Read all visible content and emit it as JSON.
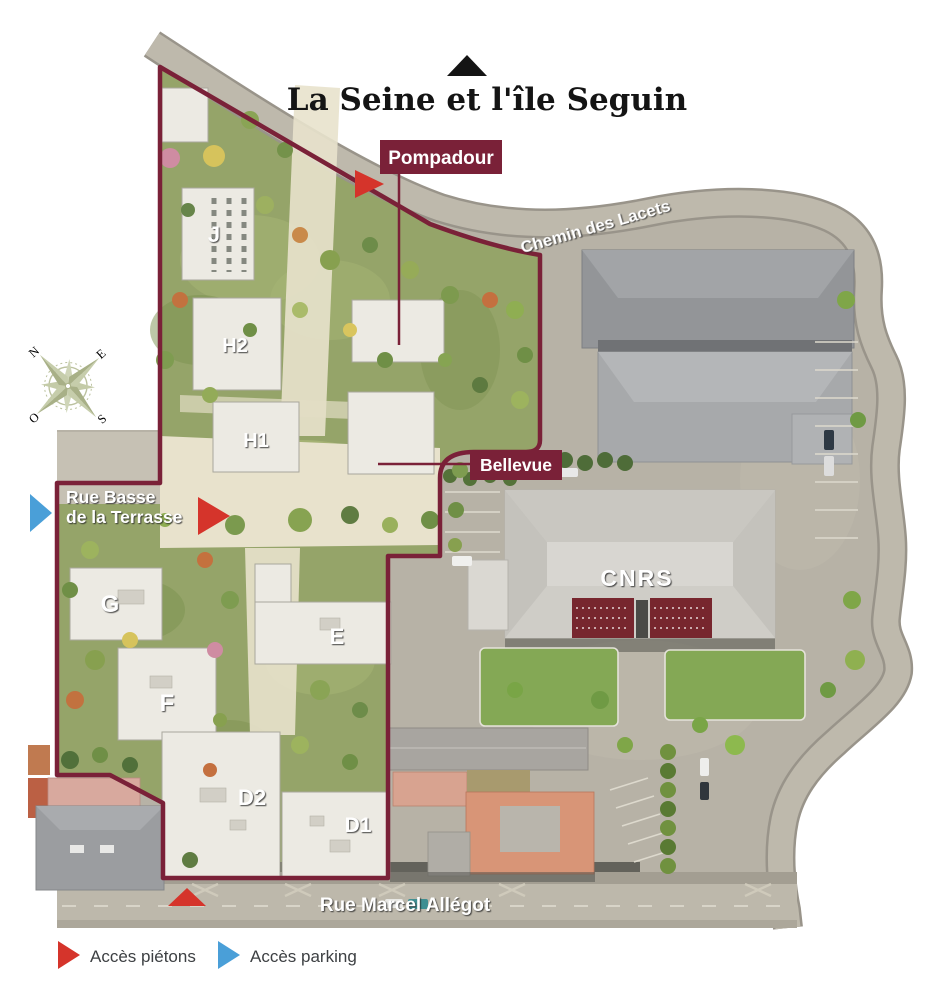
{
  "title": {
    "text": "La Seine et l'île Seguin"
  },
  "labels": {
    "pompadour": "Pompadour",
    "bellevue": "Bellevue",
    "cnrs": "CNRS"
  },
  "streets": {
    "chemin_des_lacets": "Chemin des Lacets",
    "rue_basse_line1": "Rue Basse",
    "rue_basse_line2": "de la Terrasse",
    "rue_marcel_allegot": "Rue Marcel  Allégot"
  },
  "buildings": {
    "j": "J",
    "h2": "H2",
    "h1": "H1",
    "g": "G",
    "f": "F",
    "e": "E",
    "d2": "D2",
    "d1": "D1"
  },
  "compass": {
    "n": "N",
    "e": "E",
    "s": "S",
    "o": "O"
  },
  "legend": {
    "items": [
      {
        "label": "Accès piétons",
        "color": "#d5342b"
      },
      {
        "label": "Accès parking",
        "color": "#4a9fd8"
      }
    ]
  },
  "colors": {
    "boundary": "#7a2138",
    "label_box": "#7a2138",
    "pedestrian_arrow": "#d5342b",
    "parking_arrow": "#4a9fd8"
  }
}
